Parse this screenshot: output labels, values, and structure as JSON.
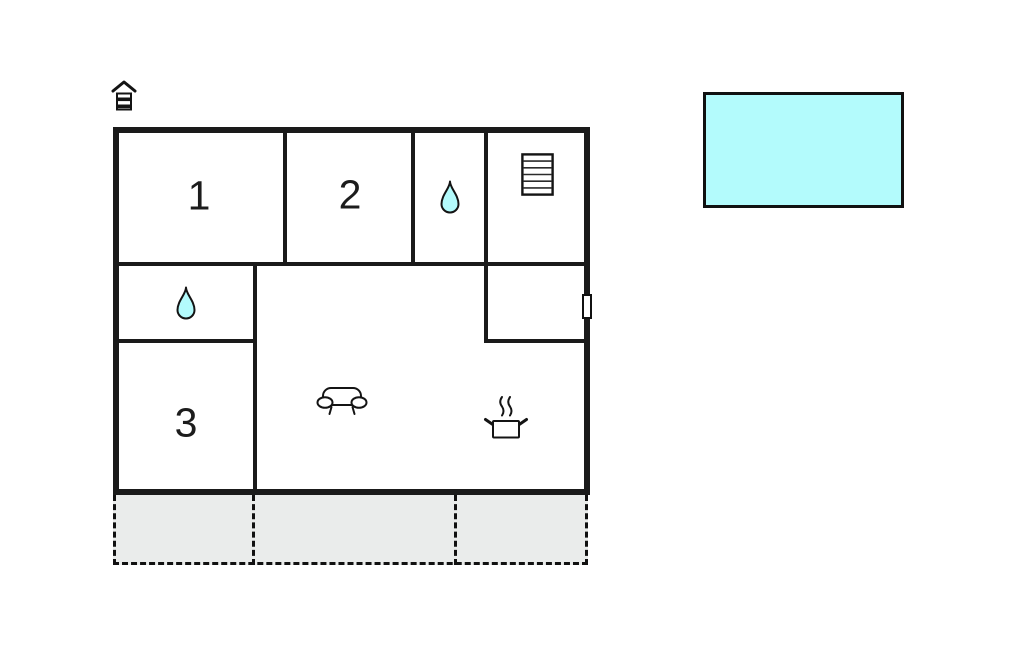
{
  "title": "floor-plan",
  "colors": {
    "wall": "#1a1a1a",
    "water": "#b3fbfc",
    "terrace": "#eaeceb",
    "background": "#ffffff"
  },
  "rooms": [
    {
      "label": "1"
    },
    {
      "label": "2"
    },
    {
      "label": "3"
    }
  ],
  "icons": {
    "entrance_marker": "house-icon",
    "bathroom_top": "water-drop-icon",
    "bathroom_left": "water-drop-icon",
    "stairs": "stairs-icon",
    "living_area": "sofa-icon",
    "kitchen": "cooking-pot-icon",
    "door": "door-marker"
  },
  "outdoor": {
    "pool": "pool",
    "terrace_sections": 3
  }
}
